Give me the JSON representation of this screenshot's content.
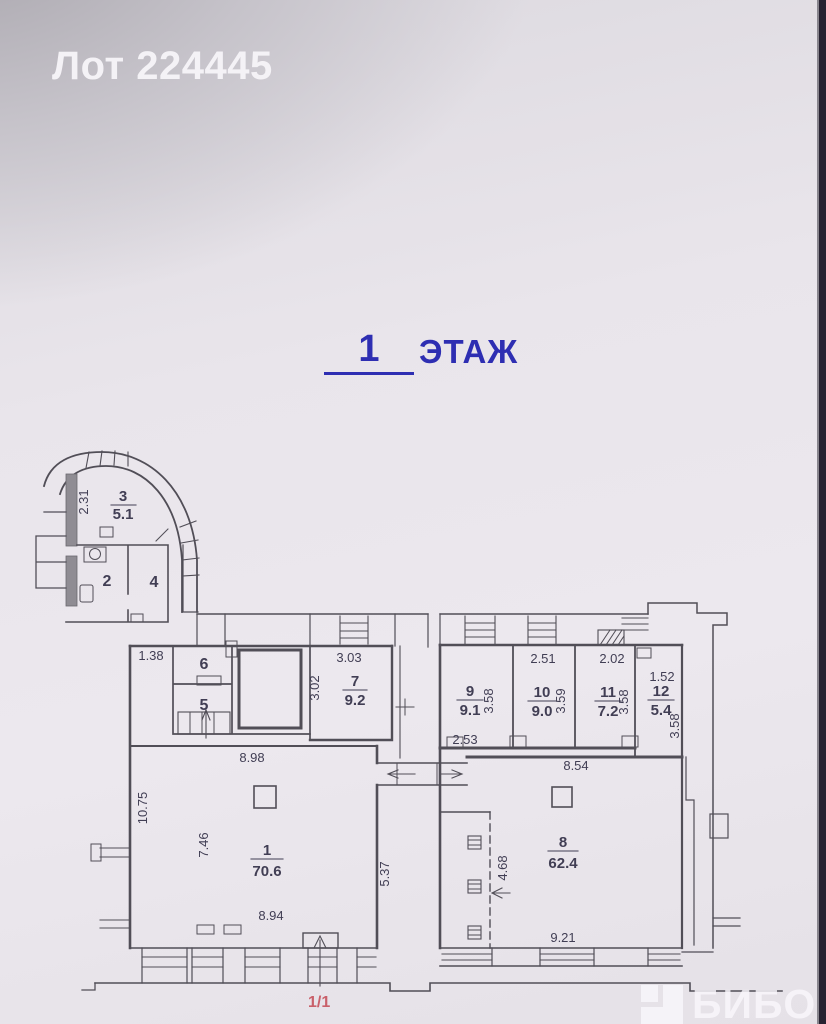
{
  "header": {
    "lot_label": "Лот 224445"
  },
  "floor_heading": {
    "number": "1",
    "word": "ЭТАЖ"
  },
  "plan": {
    "rooms": {
      "r1": {
        "number": "1",
        "area": "70.6"
      },
      "r2": {
        "number": "2"
      },
      "r3": {
        "number": "3",
        "area": "5.1"
      },
      "r4": {
        "number": "4"
      },
      "r5": {
        "number": "5"
      },
      "r6": {
        "number": "6"
      },
      "r7": {
        "number": "7",
        "area": "9.2"
      },
      "r8": {
        "number": "8",
        "area": "62.4"
      },
      "r9": {
        "number": "9",
        "area": "9.1"
      },
      "r10": {
        "number": "10",
        "area": "9.0"
      },
      "r11": {
        "number": "11",
        "area": "7.2"
      },
      "r12": {
        "number": "12",
        "area": "5.4"
      }
    },
    "dims": {
      "room3_width": "2.31",
      "niche_width": "1.38",
      "room7_width": "3.03",
      "room7_depth": "3.02",
      "room1_top": "8.98",
      "room1_left": "10.75",
      "room1_inner": "7.46",
      "room1_bottom": "8.94",
      "room1_right": "5.37",
      "room10_width": "2.51",
      "room11_width": "2.02",
      "room12_width": "1.52",
      "room9_depth": "3.58",
      "room10_depth": "3.59",
      "room11_depth": "3.58",
      "room12_depth": "3.58",
      "room9_bottom": "2.53",
      "room8_top": "8.54",
      "room8_inner": "4.68",
      "room8_bottom": "9.21"
    }
  },
  "footer": {
    "page_label": "1/1"
  },
  "watermark": {
    "text": "БИБОСС",
    "icon": "biboss-logo"
  },
  "colors": {
    "heading_blue": "#2e2eb2",
    "title_white": "#f4f2f6",
    "page_label_red": "#c44a55",
    "plan_line": "#514e57",
    "background": "#e9e5eb"
  }
}
